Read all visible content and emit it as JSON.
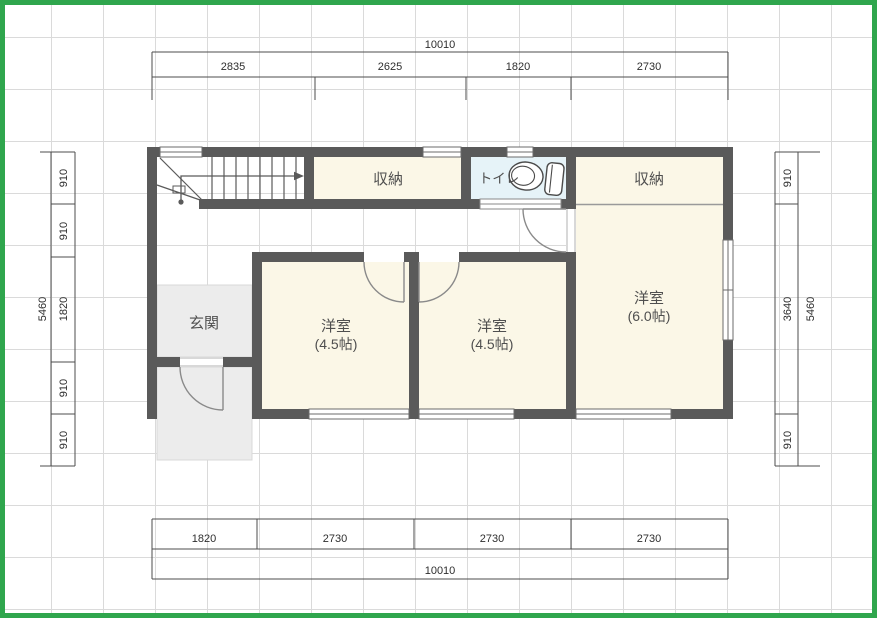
{
  "title": "2F floor plan",
  "rooms": {
    "storage_left": "収納",
    "toilet": "トイレ",
    "storage_right": "収納",
    "entrance": "玄関",
    "room1_name": "洋室",
    "room1_size": "(4.5帖)",
    "room2_name": "洋室",
    "room2_size": "(4.5帖)",
    "room3_name": "洋室",
    "room3_size": "(6.0帖)"
  },
  "dims": {
    "top": {
      "total": "10010",
      "segments": [
        "2835",
        "2625",
        "1820",
        "2730"
      ]
    },
    "bottom": {
      "total": "10010",
      "segments": [
        "1820",
        "2730",
        "2730",
        "2730"
      ]
    },
    "left": {
      "total": "5460",
      "segments": [
        "910",
        "910",
        "1820",
        "910",
        "910"
      ]
    },
    "right": {
      "total": "5460",
      "segments": [
        "910",
        "3640",
        "910"
      ]
    }
  },
  "icons": {
    "toilet": "toilet-fixture-icon",
    "stairs": "stairs-up-arrow-icon"
  },
  "colors": {
    "wall": "#5a5a5a",
    "room_fill": "#fbf7e7",
    "toilet_fill": "#e6f3f8",
    "entry_fill": "#ececec",
    "frame_green": "#2fa64d",
    "grid": "#dadada",
    "dim_line": "#4d4d4d"
  }
}
